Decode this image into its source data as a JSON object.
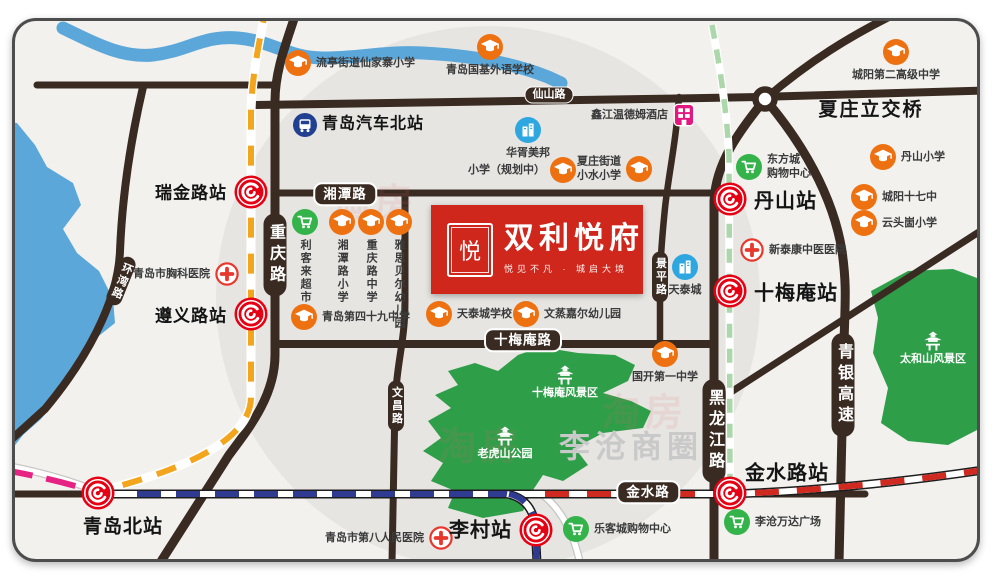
{
  "colors": {
    "map_bg": "#f2f1ee",
    "zone_circle": "#e7e5e2",
    "border": "#4d4d4d",
    "road": "#3a2b22",
    "water": "#5ba7d9",
    "park": "#2f9e49",
    "metro_red": "#e60013",
    "school_orange": "#ee7111",
    "shop_green": "#33b34a",
    "hospital_red": "#e8382d",
    "blue_icon": "#2ea7e0",
    "bus_navy": "#224091",
    "hotel_pink": "#e0187f",
    "line_yellow": "#f2a51d",
    "line_blue": "#2e3b90",
    "line_pink": "#e62383",
    "line_green": "#abd7ab",
    "line_rail_red": "#d02920",
    "area_gray": "#c9c9c9",
    "logo_red": "#d0271d"
  },
  "icons": {
    "metro-logo-icon": "red circle, white ring, white swirl (Qingdao Metro)",
    "graduation-cap-icon": "orange circle with white mortarboard",
    "shopping-cart-icon": "green circle with white cart",
    "hospital-cross-icon": "white circle, red border, red cross",
    "building-icon": "blue circle with white buildings",
    "bus-icon": "navy circle with white bus",
    "hotel-icon": "magenta rounded square with white window grid",
    "pagoda-icon": "white pagoda on green park"
  },
  "logo": {
    "title": "双利悦府",
    "subtitle": "悦见不凡 · 城启大境",
    "seal_char": "悦"
  },
  "watermark": {
    "text": "淘房",
    "positions": [
      [
        372,
        196
      ],
      [
        478,
        440
      ],
      [
        642,
        406
      ]
    ]
  },
  "area_labels": [
    {
      "name": "xiazhuang-interchange-label",
      "text": "夏庄立交桥",
      "x": 868,
      "y": 105,
      "size": 19,
      "color": "#151515",
      "ls": 2
    },
    {
      "name": "licang-business-circle-label",
      "text": "李沧商圈",
      "x": 628,
      "y": 441,
      "size": 31,
      "color": "#c9c9c9",
      "ls": 5
    }
  ],
  "park_labels": [
    {
      "name": "shimeian-scenic-area",
      "text": "十梅庵风景区",
      "x": 562,
      "y": 389
    },
    {
      "name": "laohushan-park",
      "text": "老虎山公园",
      "x": 502,
      "y": 450
    },
    {
      "name": "taiheshan-scenic-area",
      "text": "太和山风景区",
      "x": 930,
      "y": 355
    }
  ],
  "road_badges": [
    {
      "name": "xianshan-road",
      "text": "仙山路",
      "x": 546,
      "y": 92,
      "type": "h-sm"
    },
    {
      "name": "xiangtan-road",
      "text": "湘潭路",
      "x": 342,
      "y": 191,
      "type": "h-lg"
    },
    {
      "name": "shimeian-road",
      "text": "十梅庵路",
      "x": 520,
      "y": 337,
      "type": "h-lg"
    },
    {
      "name": "jinshui-road",
      "text": "金水路",
      "x": 645,
      "y": 489,
      "type": "h-lg"
    },
    {
      "name": "chongqing-road",
      "text": "重庆路",
      "x": 272,
      "y": 252,
      "type": "v-lg"
    },
    {
      "name": "heilongjiang-road",
      "text": "黑龙江路",
      "x": 711,
      "y": 428,
      "type": "v-lg"
    },
    {
      "name": "qingyin-expressway",
      "text": "青银高速",
      "x": 840,
      "y": 382,
      "type": "v-lg"
    },
    {
      "name": "jingping-road",
      "text": "景平路",
      "x": 657,
      "y": 274,
      "type": "v-sm"
    },
    {
      "name": "wenchang-road",
      "text": "文昌路",
      "x": 393,
      "y": 403,
      "type": "v-sm"
    },
    {
      "name": "huanwan-road",
      "text": "环湾路",
      "x": 118,
      "y": 278,
      "type": "v-sm",
      "rot": 22
    }
  ],
  "stations": [
    {
      "name": "ruijin-road-station",
      "label": "瑞金路站",
      "x": 248,
      "y": 189,
      "lx": 224,
      "ly": 188,
      "anchor": "end",
      "size": 17
    },
    {
      "name": "zunyi-road-station",
      "label": "遵义路站",
      "x": 248,
      "y": 311,
      "lx": 224,
      "ly": 311,
      "anchor": "end",
      "size": 17
    },
    {
      "name": "danshan-station",
      "label": "丹山站",
      "x": 727,
      "y": 196,
      "lx": 751,
      "ly": 196,
      "anchor": "start",
      "size": 20
    },
    {
      "name": "shimeian-station",
      "label": "十梅庵站",
      "x": 727,
      "y": 288,
      "lx": 751,
      "ly": 288,
      "anchor": "start",
      "size": 20
    },
    {
      "name": "jinshui-road-station",
      "label": "金水路站",
      "x": 727,
      "y": 490,
      "lx": 742,
      "ly": 468,
      "anchor": "start",
      "size": 20
    },
    {
      "name": "licun-station",
      "label": "李村站",
      "x": 533,
      "y": 527,
      "lx": 509,
      "ly": 525,
      "anchor": "end",
      "size": 20
    },
    {
      "name": "qingdao-north-station",
      "label": "青岛北站",
      "x": 95,
      "y": 490,
      "lx": 80,
      "ly": 522,
      "anchor": "start",
      "size": 19
    }
  ],
  "pois": [
    {
      "name": "liuting-xianjiazhai-primary",
      "icon": "school",
      "x": 295,
      "y": 60,
      "label": "流亭街道仙家寨小学",
      "lp": "right"
    },
    {
      "name": "guoji-foreign-language-school",
      "icon": "school",
      "x": 487,
      "y": 44,
      "label": "青岛国基外语学校",
      "lp": "below"
    },
    {
      "name": "chengyang-no2-high-school",
      "icon": "school",
      "x": 893,
      "y": 49,
      "label": "城阳第二高级中学",
      "lp": "below"
    },
    {
      "name": "danshan-primary",
      "icon": "school",
      "x": 880,
      "y": 154,
      "label": "丹山小学",
      "lp": "right"
    },
    {
      "name": "chengyang-no17-middle",
      "icon": "school",
      "x": 861,
      "y": 194,
      "label": "城阳十七中",
      "lp": "right"
    },
    {
      "name": "yuntougu-primary",
      "icon": "school",
      "x": 861,
      "y": 220,
      "label": "云头崮小学",
      "lp": "right"
    },
    {
      "name": "planned-primary",
      "icon": "school",
      "x": 560,
      "y": 167,
      "label": "小学（规划中）",
      "lp": "left"
    },
    {
      "name": "xiaoshui-primary",
      "icon": "school",
      "x": 636,
      "y": 166,
      "label": "夏庄街道\n小水小学",
      "lp": "left"
    },
    {
      "name": "qingdao-no49-middle",
      "icon": "school",
      "x": 301,
      "y": 314,
      "label": "青岛第四十九中学",
      "lp": "right"
    },
    {
      "name": "tiantaicheng-school",
      "icon": "school",
      "x": 436,
      "y": 311,
      "label": "天泰城学校",
      "lp": "right"
    },
    {
      "name": "wenzheng-jiaer-kindergarten",
      "icon": "school",
      "x": 523,
      "y": 311,
      "label": "文蒸嘉尔幼儿园",
      "lp": "right"
    },
    {
      "name": "guokai-no1-middle",
      "icon": "school",
      "x": 662,
      "y": 351,
      "label": "国开第一中学",
      "lp": "below"
    },
    {
      "name": "xiangtan-road-primary",
      "icon": "school",
      "x": 339,
      "y": 219,
      "label": "湘潭路小学",
      "lp": "below-vert"
    },
    {
      "name": "chongqing-road-middle",
      "icon": "school",
      "x": 368,
      "y": 219,
      "label": "重庆路中学",
      "lp": "below-vert"
    },
    {
      "name": "yasi-beier-kindergarten",
      "icon": "school",
      "x": 396,
      "y": 219,
      "label": "雅思贝尔幼儿园",
      "lp": "below-vert"
    },
    {
      "name": "likelai-supermarket",
      "icon": "cart",
      "x": 302,
      "y": 219,
      "label": "利客来超市",
      "lp": "below-vert"
    },
    {
      "name": "dongfangcheng-mall",
      "icon": "cart",
      "x": 746,
      "y": 164,
      "label": "东方城\n购物中心",
      "lp": "right"
    },
    {
      "name": "lekecheng-mall",
      "icon": "cart",
      "x": 573,
      "y": 526,
      "label": "乐客城购物中心",
      "lp": "right"
    },
    {
      "name": "licang-wanda-plaza",
      "icon": "cart",
      "x": 734,
      "y": 519,
      "label": "李沧万达广场",
      "lp": "right"
    },
    {
      "name": "qingdao-chest-hospital",
      "icon": "hospital",
      "x": 224,
      "y": 271,
      "label": "青岛市胸科医院",
      "lp": "left"
    },
    {
      "name": "xintaikang-tcm-hospital",
      "icon": "hospital",
      "x": 749,
      "y": 247,
      "label": "新泰康中医医院",
      "lp": "right"
    },
    {
      "name": "qingdao-no8-peoples-hospital",
      "icon": "hospital",
      "x": 438,
      "y": 535,
      "label": "青岛市第八人民医院",
      "lp": "left"
    },
    {
      "name": "huaxu-meibang",
      "icon": "building",
      "x": 525,
      "y": 127,
      "label": "华胥美邦",
      "lp": "below"
    },
    {
      "name": "tiantaicheng",
      "icon": "building",
      "x": 682,
      "y": 264,
      "label": "天泰城",
      "lp": "below"
    },
    {
      "name": "xinjiang-wyndham-hotel",
      "icon": "hotel",
      "x": 681,
      "y": 112,
      "label": "鑫江温德姆酒店",
      "lp": "left"
    },
    {
      "name": "qingdao-bus-north-station",
      "icon": "bus",
      "x": 302,
      "y": 122,
      "label": "青岛汽车北站",
      "lp": "right",
      "big": true
    }
  ]
}
